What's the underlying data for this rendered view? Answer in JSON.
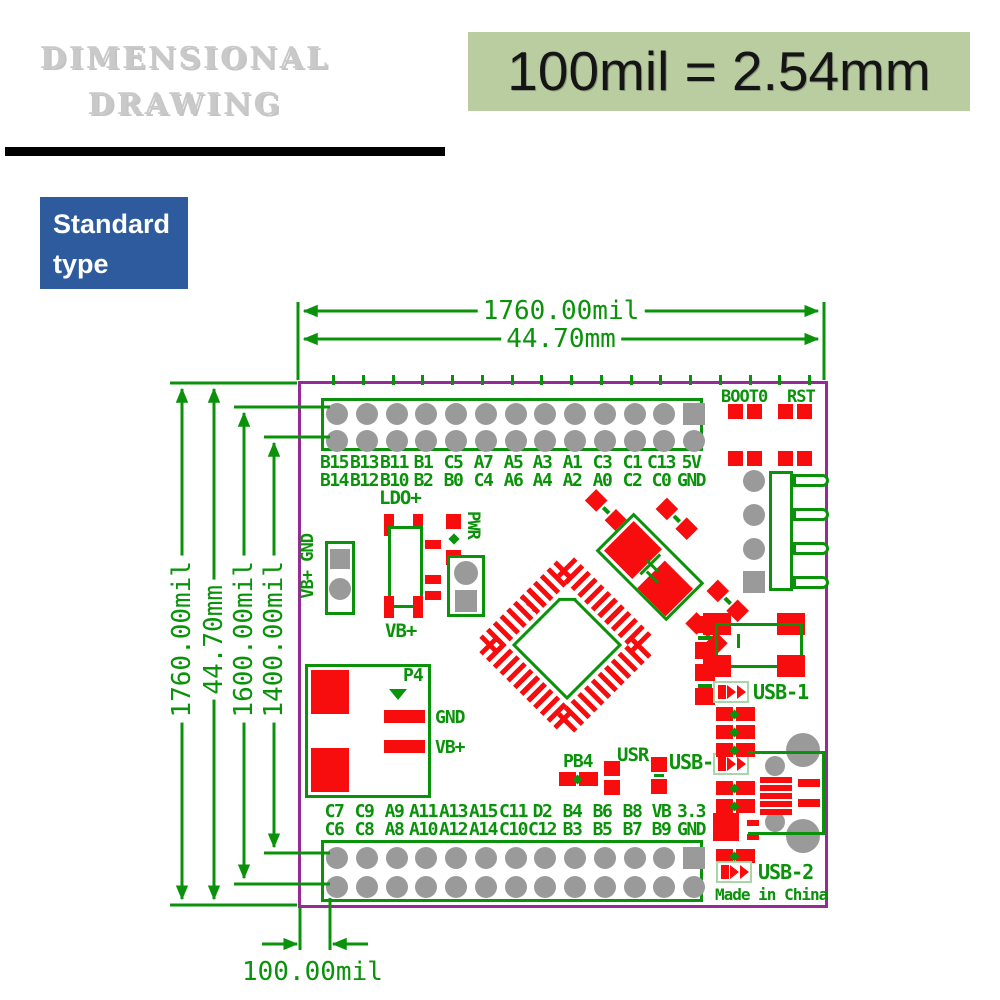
{
  "title": {
    "line1": "DIMENSIONAL",
    "line2": "DRAWING"
  },
  "note": {
    "text": "100mil = 2.54mm"
  },
  "badge": {
    "line1": "Standard",
    "line2": "type"
  },
  "dimensions": {
    "top_mil": "1760.00mil",
    "top_mm": "44.70mm",
    "left_mil": "1760.00mil",
    "left_mm": "44.70mm",
    "left_inner1": "1600.00mil",
    "left_inner2": "1400.00mil",
    "pitch": "100.00mil"
  },
  "board": {
    "boot0": "BOOT0",
    "rst": "RST",
    "top_pins_row1": [
      "B15",
      "B13",
      "B11",
      "B1",
      "C5",
      "A7",
      "A5",
      "A3",
      "A1",
      "C3",
      "C1",
      "C13",
      "5V"
    ],
    "top_pins_row2": [
      "B14",
      "B12",
      "B10",
      "B2",
      "B0",
      "C4",
      "A6",
      "A4",
      "A2",
      "A0",
      "C2",
      "C0",
      "GND"
    ],
    "bottom_pins_row1": [
      "C7",
      "C9",
      "A9",
      "A11",
      "A13",
      "A15",
      "C11",
      "D2",
      "B4",
      "B6",
      "B8",
      "VB",
      "3.3"
    ],
    "bottom_pins_row2": [
      "C6",
      "C8",
      "A8",
      "A10",
      "A12",
      "A14",
      "C10",
      "C12",
      "B3",
      "B5",
      "B7",
      "B9",
      "GND"
    ],
    "ldo": "LDO+",
    "ldo_vb": "VB+",
    "battery_conn": "VB+ GND",
    "pwr": "PWR",
    "p4": "P4",
    "p4_gnd": "GND",
    "p4_vb": "VB+",
    "pb4": "PB4",
    "usr": "USR",
    "usb0": "USB-0",
    "usb1": "USB-1",
    "usb2": "USB-2",
    "made_in": "Made in China"
  },
  "colors": {
    "outline": "#962a96",
    "silk": "#0a930a",
    "pad": "#f70d0d",
    "hole": "#9a9a9a",
    "note_bg": "#b9cda1",
    "badge_bg": "#2e5b9d",
    "title": "#c9c9c9"
  }
}
